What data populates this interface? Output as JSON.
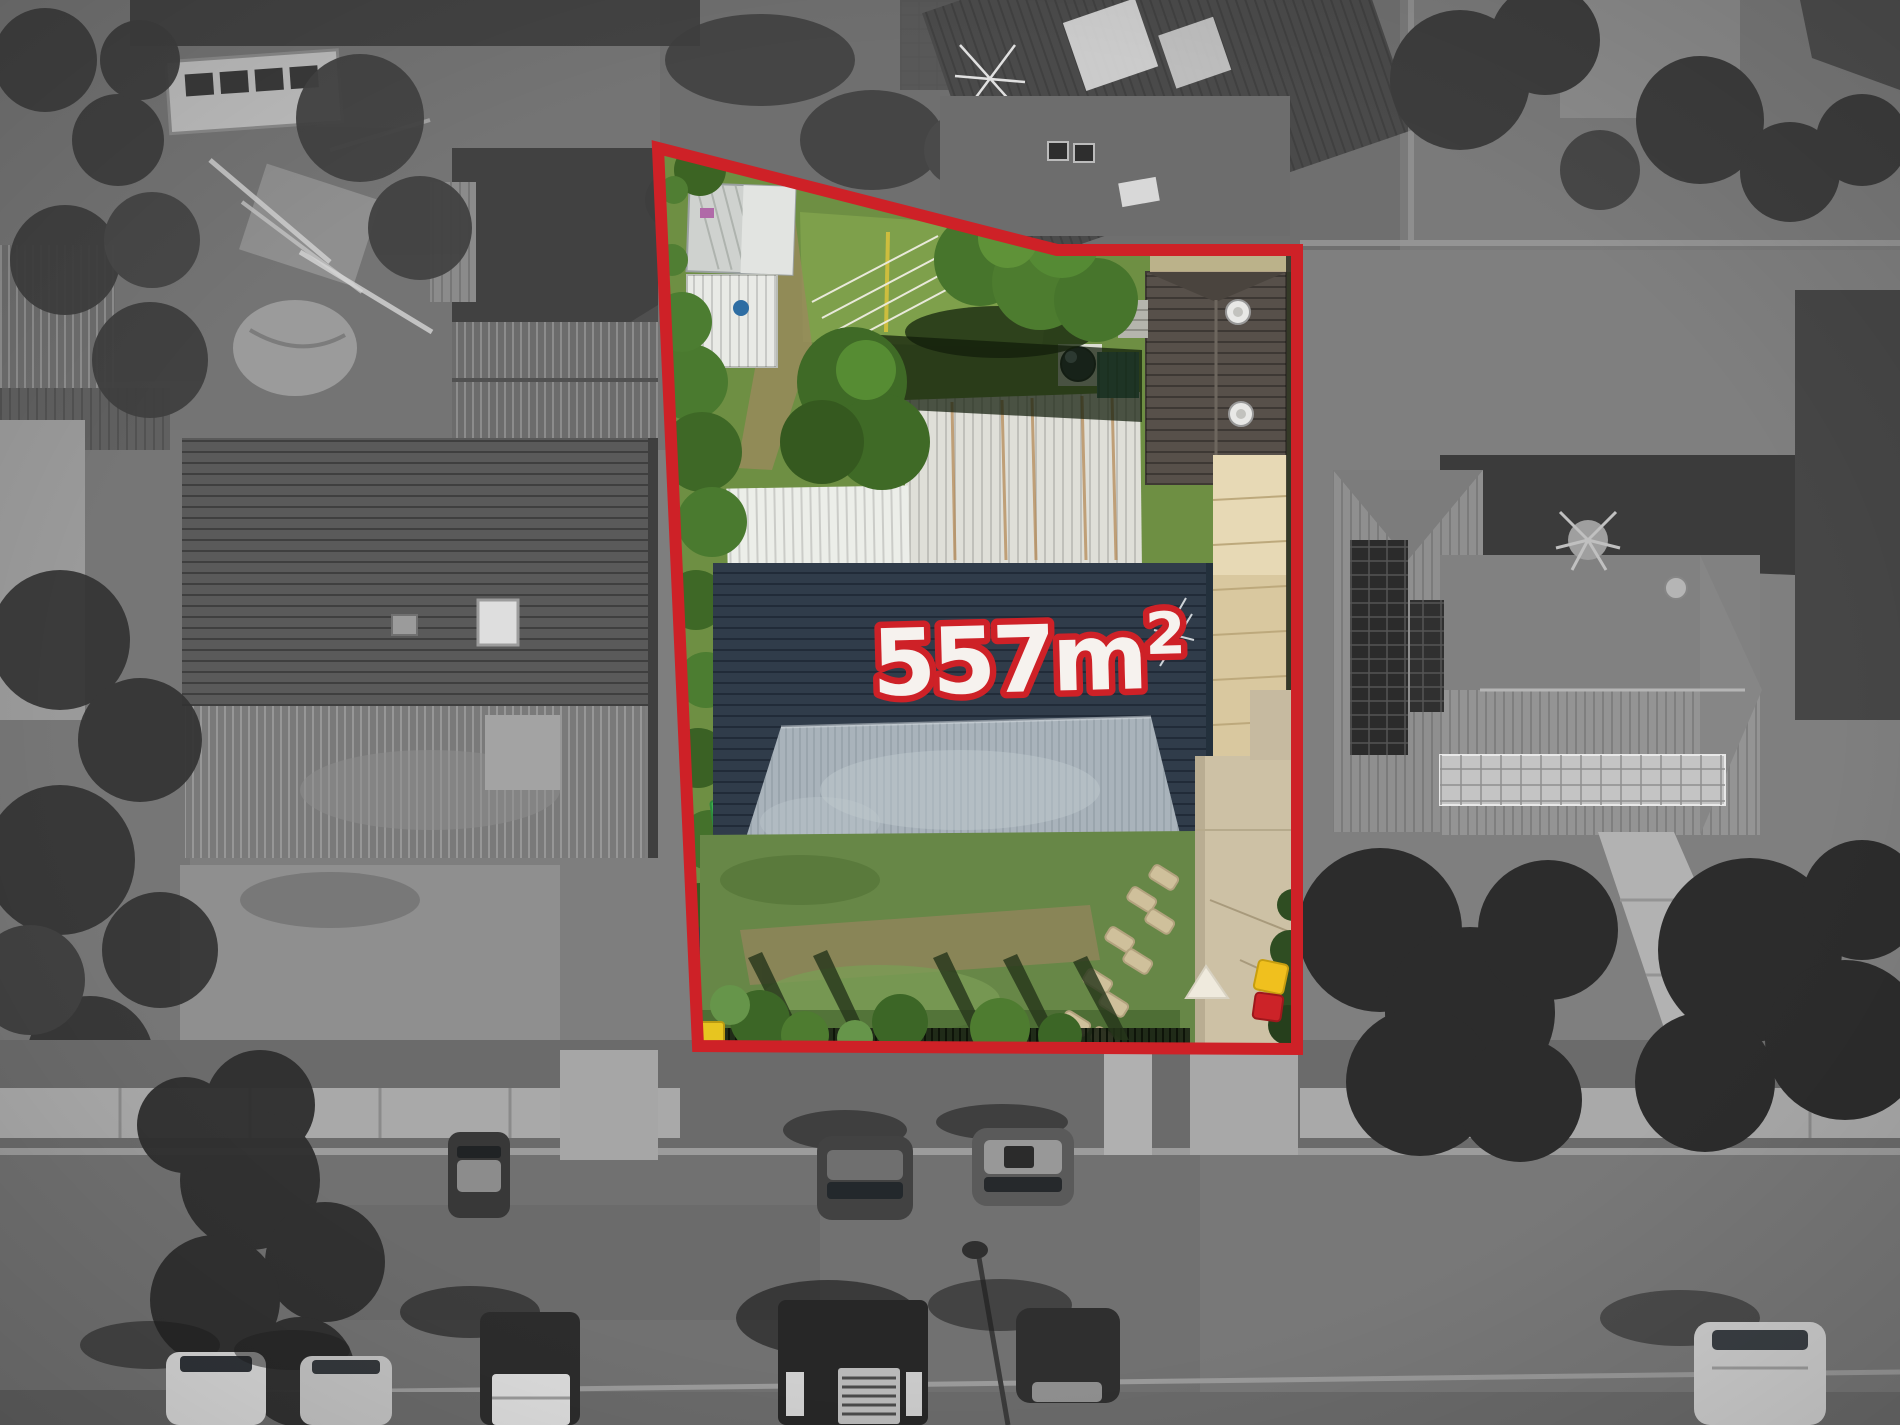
{
  "photo": {
    "kind": "aerial-drone-real-estate-photo",
    "area_label": {
      "value": "557m",
      "superscript": "2",
      "full": "557m²"
    },
    "boundary": {
      "points": "658,148 1057,250 1297,250 1297,1049 698,1046",
      "color": "#ce2127",
      "stroke_width": "12"
    },
    "colors": {
      "label_fill": "#f6f2ee",
      "label_outline": "#ce2127",
      "lot_lawn_green": "#678747",
      "back_lawn_green": "#7ea04b",
      "main_roof_dark": "#303c4a",
      "main_roof_weathered": "#a9b3bb",
      "patio_awning_tan": "#d9c89f",
      "driveway_beige": "#cdc1a5",
      "surroundings": "grayscale"
    }
  }
}
